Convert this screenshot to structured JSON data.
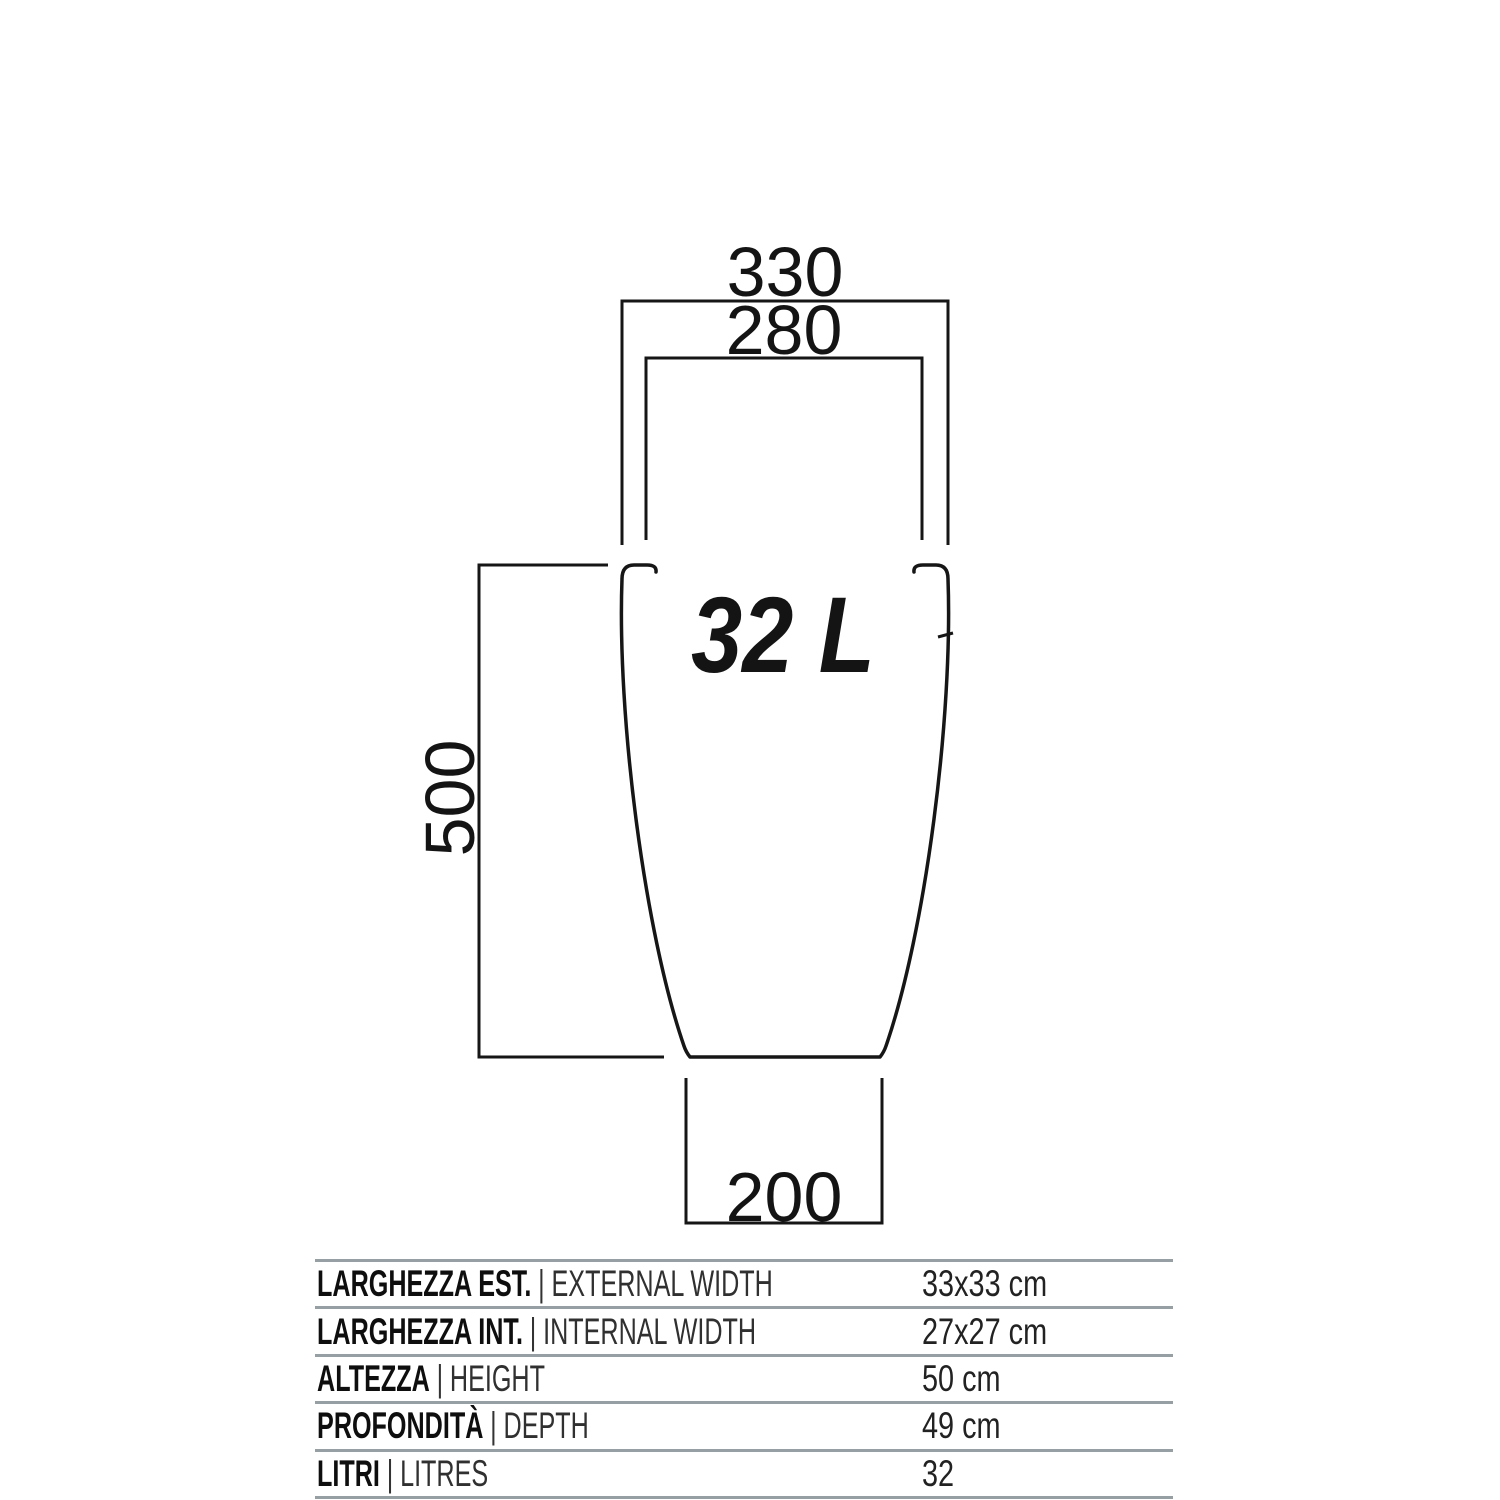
{
  "diagram": {
    "volume_label": "32 L",
    "dimensions": {
      "external_width": "330",
      "internal_width": "280",
      "height": "500",
      "base_width": "200"
    }
  },
  "spec_table": {
    "separator": "|",
    "rows": [
      {
        "label_it": "LARGHEZZA EST.",
        "label_en": "EXTERNAL WIDTH",
        "value": "33x33 cm"
      },
      {
        "label_it": "LARGHEZZA INT.",
        "label_en": "INTERNAL WIDTH",
        "value": "27x27 cm"
      },
      {
        "label_it": "ALTEZZA",
        "label_en": "HEIGHT",
        "value": "50 cm"
      },
      {
        "label_it": "PROFONDITÀ",
        "label_en": "DEPTH",
        "value": "49 cm"
      },
      {
        "label_it": "LITRI",
        "label_en": "LITRES",
        "value": "32"
      }
    ]
  },
  "colors": {
    "line": "#161616",
    "table_rule": "#96a0a4",
    "background": "#ffffff"
  }
}
